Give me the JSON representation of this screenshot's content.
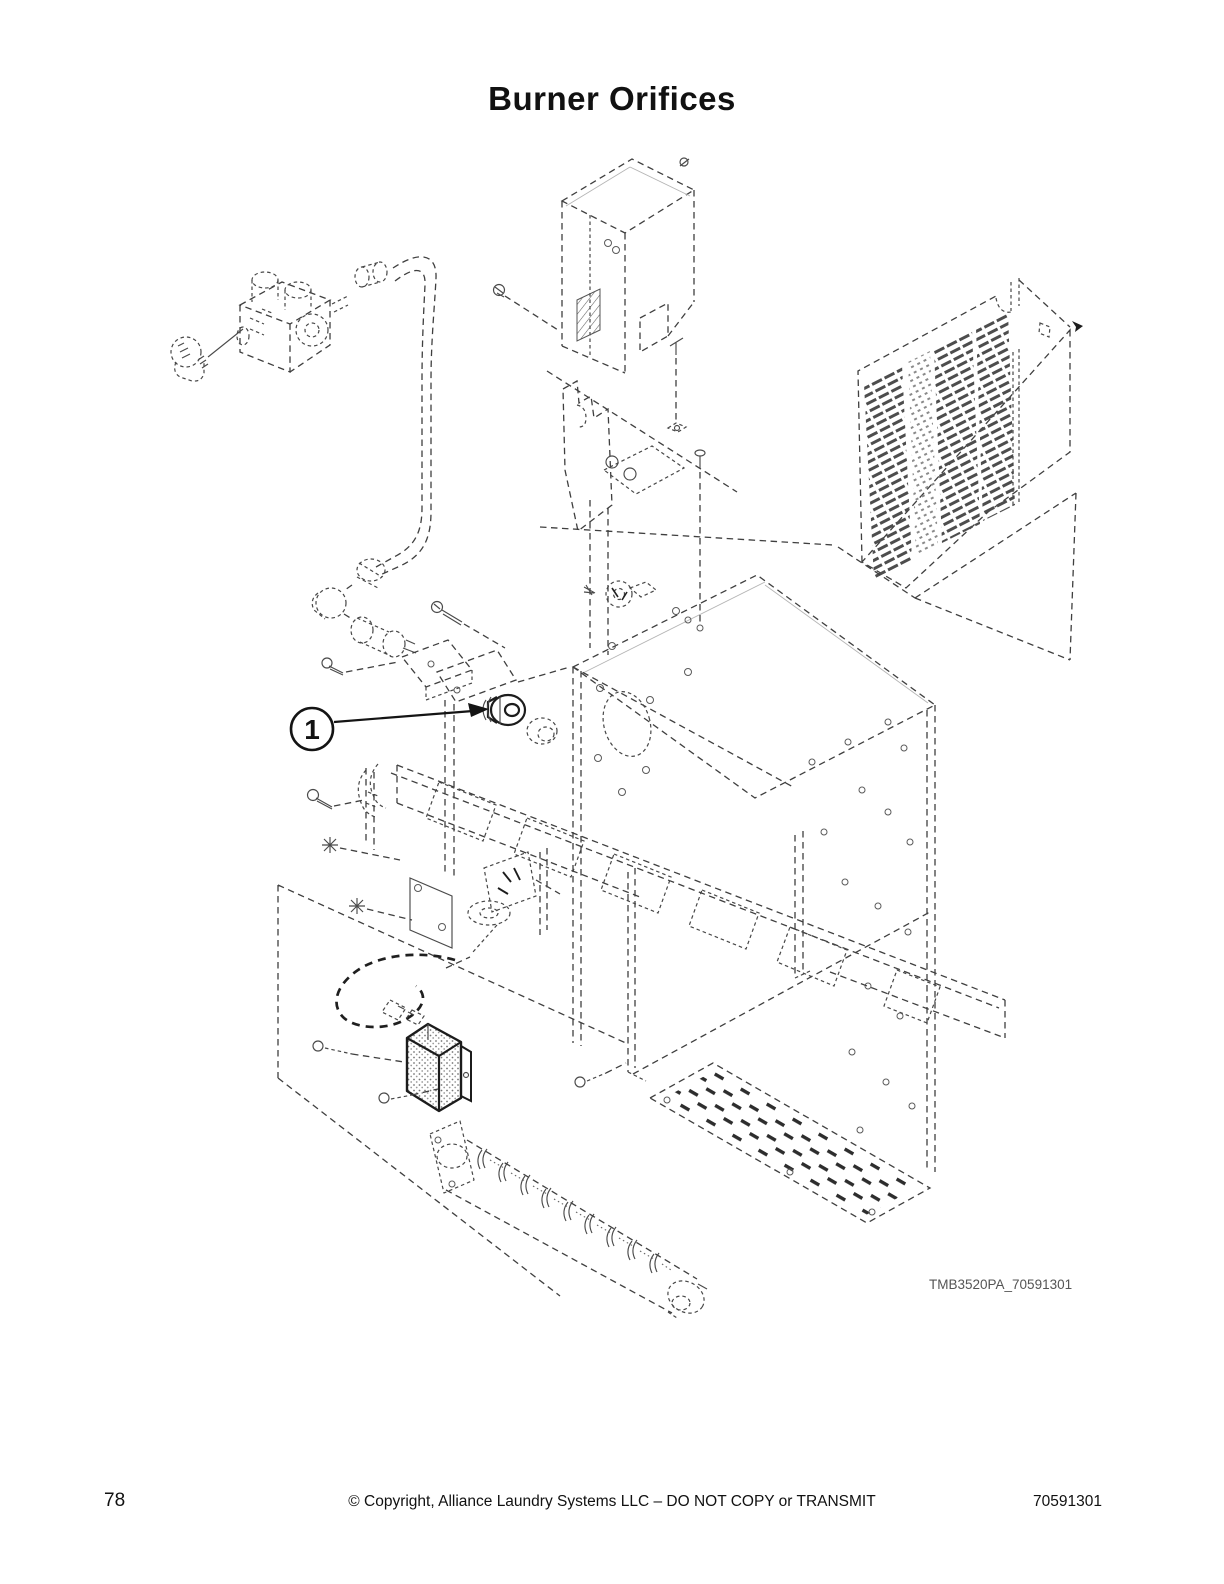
{
  "page": {
    "title": "Burner Orifices",
    "diagram_code": "TMB3520PA_70591301",
    "footer": {
      "page_number": "78",
      "copyright": "© Copyright, Alliance Laundry Systems LLC – DO NOT COPY or TRANSMIT",
      "document_number": "70591301"
    }
  },
  "diagram": {
    "type": "exploded-parts-illustration",
    "callouts": [
      {
        "label": "1"
      }
    ],
    "colors": {
      "line": "#3f3f3f",
      "bold_line": "#1c1c1c",
      "label_text": "#555555",
      "page_text": "#111111"
    }
  }
}
